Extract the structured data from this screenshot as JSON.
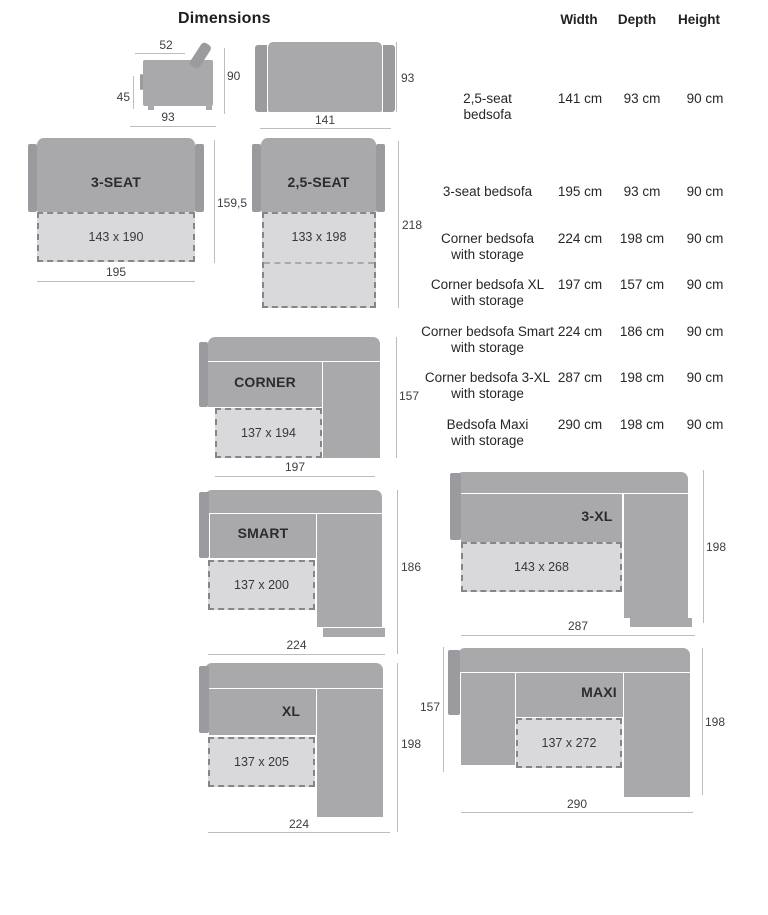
{
  "title": "Dimensions",
  "table": {
    "headers": {
      "width": "Width",
      "depth": "Depth",
      "height": "Height"
    },
    "rows": [
      {
        "name_lines": [
          "2,5-seat",
          "bedsofa"
        ],
        "width": "141 cm",
        "depth": "93 cm",
        "height": "90 cm"
      },
      {
        "name_lines": [
          "3-seat bedsofa"
        ],
        "width": "195 cm",
        "depth": "93 cm",
        "height": "90 cm"
      },
      {
        "name_lines": [
          "Corner bedsofa",
          "with storage"
        ],
        "width": "224 cm",
        "depth": "198 cm",
        "height": "90 cm"
      },
      {
        "name_lines": [
          "Corner bedsofa XL",
          "with storage"
        ],
        "width": "197 cm",
        "depth": "157 cm",
        "height": "90 cm"
      },
      {
        "name_lines": [
          "Corner bedsofa Smart",
          "with storage"
        ],
        "width": "224 cm",
        "depth": "186 cm",
        "height": "90 cm"
      },
      {
        "name_lines": [
          "Corner bedsofa 3-XL",
          "with storage"
        ],
        "width": "287 cm",
        "depth": "198 cm",
        "height": "90 cm"
      },
      {
        "name_lines": [
          "Bedsofa Maxi",
          "with storage"
        ],
        "width": "290 cm",
        "depth": "198 cm",
        "height": "90 cm"
      }
    ]
  },
  "diagrams": {
    "side_view": {
      "top": "52",
      "left": "45",
      "bottom": "93",
      "right": "90"
    },
    "front_view": {
      "bottom": "141",
      "right": "93"
    },
    "three_seat": {
      "label": "3-SEAT",
      "bed": "143 x 190",
      "bottom": "195",
      "right": "159,5"
    },
    "two_five_seat": {
      "label": "2,5-SEAT",
      "bed": "133 x 198",
      "right": "218"
    },
    "corner": {
      "label": "CORNER",
      "bed": "137 x 194",
      "bottom": "197",
      "right": "157"
    },
    "smart": {
      "label": "SMART",
      "bed": "137 x 200",
      "bottom": "224",
      "right": "186"
    },
    "three_xl": {
      "label": "3-XL",
      "bed": "143 x 268",
      "bottom": "287",
      "right": "198"
    },
    "xl": {
      "label": "XL",
      "bed": "137 x 205",
      "bottom": "224",
      "right": "198"
    },
    "maxi": {
      "label": "MAXI",
      "bed": "137 x 272",
      "bottom": "290",
      "right": "198",
      "left": "157"
    }
  },
  "colors": {
    "sofa_body": "#a9a9ac",
    "sofa_arm": "#9b9b9f",
    "bed_fill": "#d9d9db",
    "bed_border": "#85858a",
    "dim_line": "#bdbdc0",
    "dim_text": "#3e3e42",
    "label_text": "#2c2c30",
    "table_text": "#27272b"
  }
}
